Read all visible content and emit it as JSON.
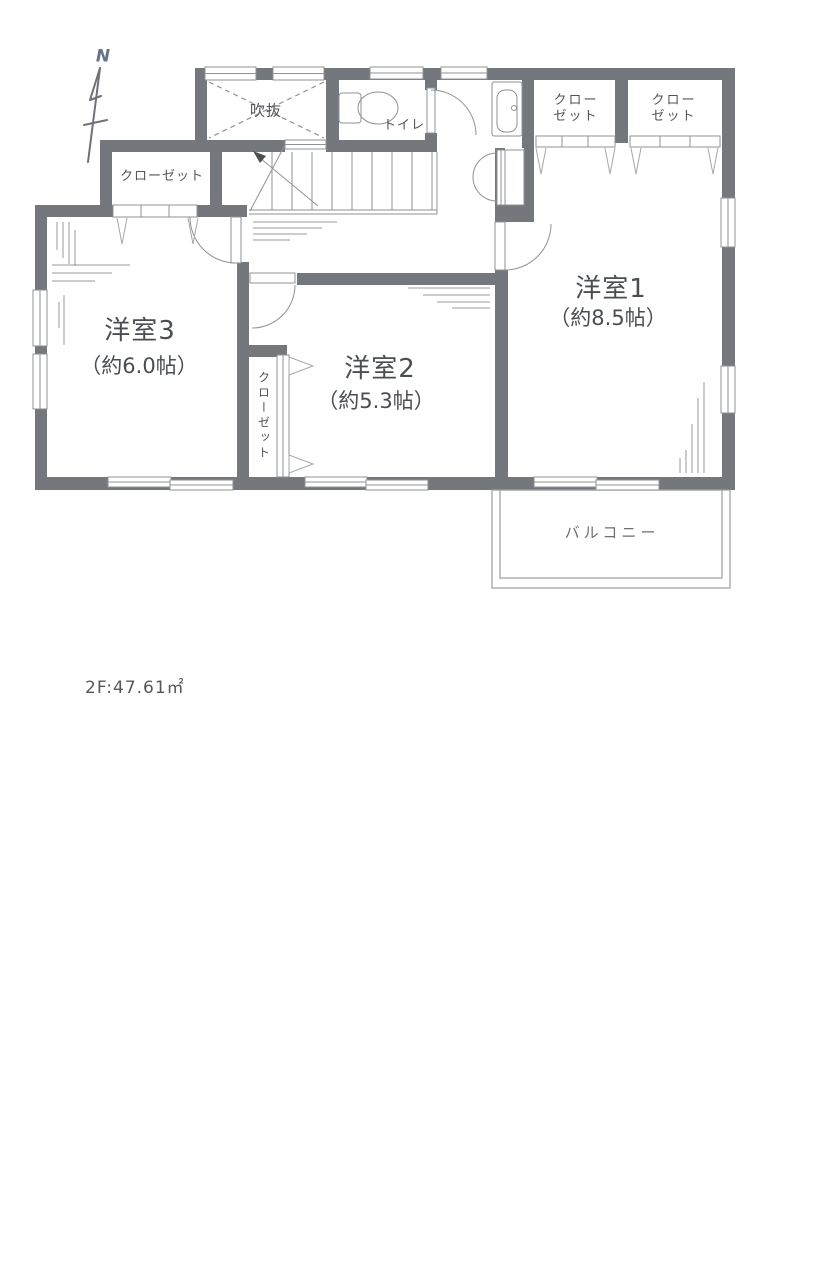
{
  "colors": {
    "wall": "#74777b",
    "thin_line": "#8f9296",
    "light_line": "#a5a8ab",
    "text": "#4a4e53",
    "compass": "#64748b"
  },
  "compass": {
    "label": "N"
  },
  "plan": {
    "rooms": {
      "room1": {
        "name": "洋室1",
        "size": "（約8.5帖）"
      },
      "room2": {
        "name": "洋室2",
        "size": "（約5.3帖）"
      },
      "room3": {
        "name": "洋室3",
        "size": "（約6.0帖）"
      },
      "void": {
        "name": "吹抜"
      },
      "toilet": {
        "name": "トイレ"
      },
      "balcony": {
        "name": "バルコニー"
      },
      "closet_top_left": {
        "name": "クローゼット"
      },
      "closet_middle": {
        "name": "クローゼット"
      },
      "closet_right_1": {
        "name": "クロー\nゼット"
      },
      "closet_right_2": {
        "name": "クロー\nゼット"
      }
    },
    "floor_area_label": "2F:47.61㎡"
  }
}
